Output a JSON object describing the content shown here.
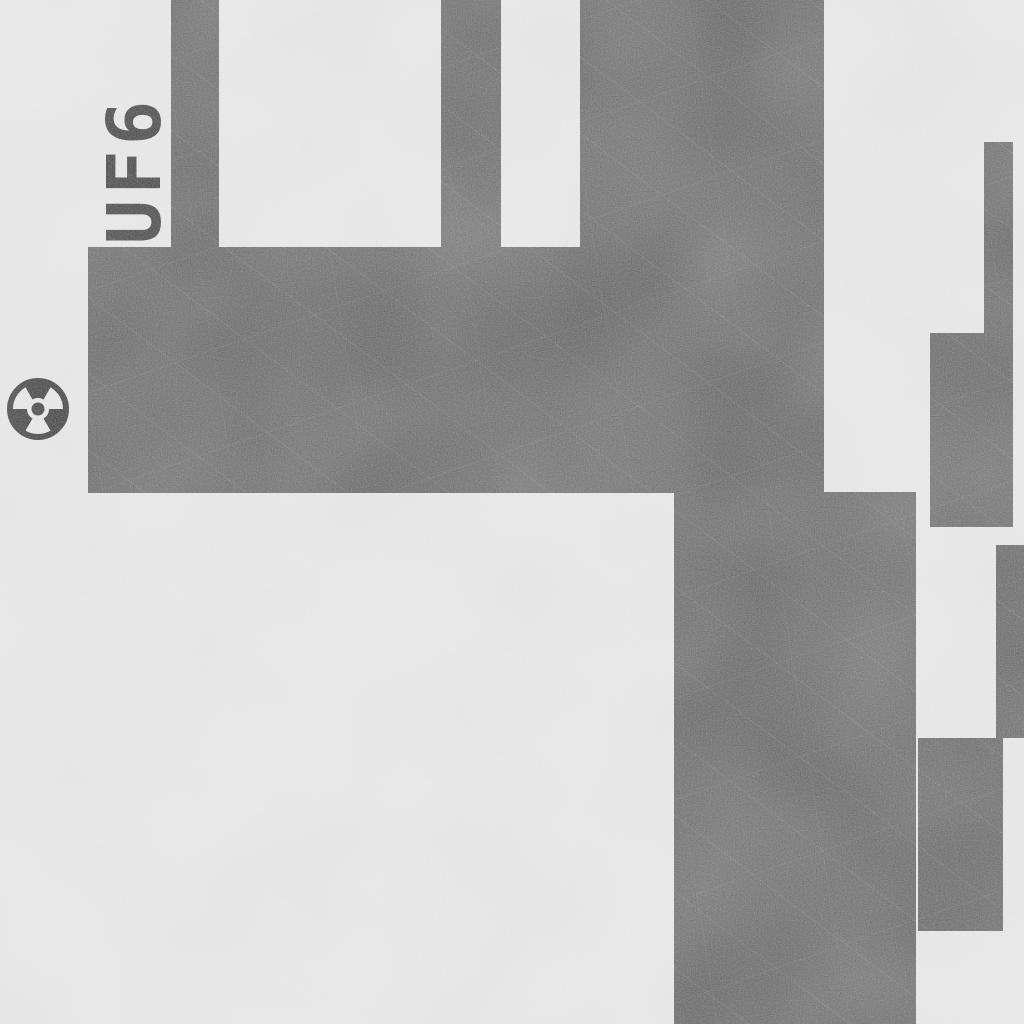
{
  "scene": {
    "label": "UF6",
    "label_pos": {
      "cx": 135,
      "cy": 170,
      "rotation_deg": -90
    },
    "radiation_icon": {
      "name": "radiation-icon",
      "cx": 38,
      "cy": 409,
      "outer_radius": 32
    },
    "colors": {
      "background": "#dadadb",
      "wall": "#3c3c3e",
      "ink": "#0c0c0c"
    },
    "walls": [
      {
        "x": 171,
        "y": 0,
        "w": 48,
        "h": 248
      },
      {
        "x": 441,
        "y": 0,
        "w": 60,
        "h": 248
      },
      {
        "x": 580,
        "y": 0,
        "w": 244,
        "h": 248
      },
      {
        "x": 88,
        "y": 247,
        "w": 736,
        "h": 246
      },
      {
        "x": 674,
        "y": 492,
        "w": 242,
        "h": 532
      },
      {
        "x": 984,
        "y": 142,
        "w": 29,
        "h": 192
      },
      {
        "x": 930,
        "y": 333,
        "w": 83,
        "h": 194
      },
      {
        "x": 996,
        "y": 545,
        "w": 28,
        "h": 193
      },
      {
        "x": 918,
        "y": 738,
        "w": 85,
        "h": 193
      }
    ]
  }
}
